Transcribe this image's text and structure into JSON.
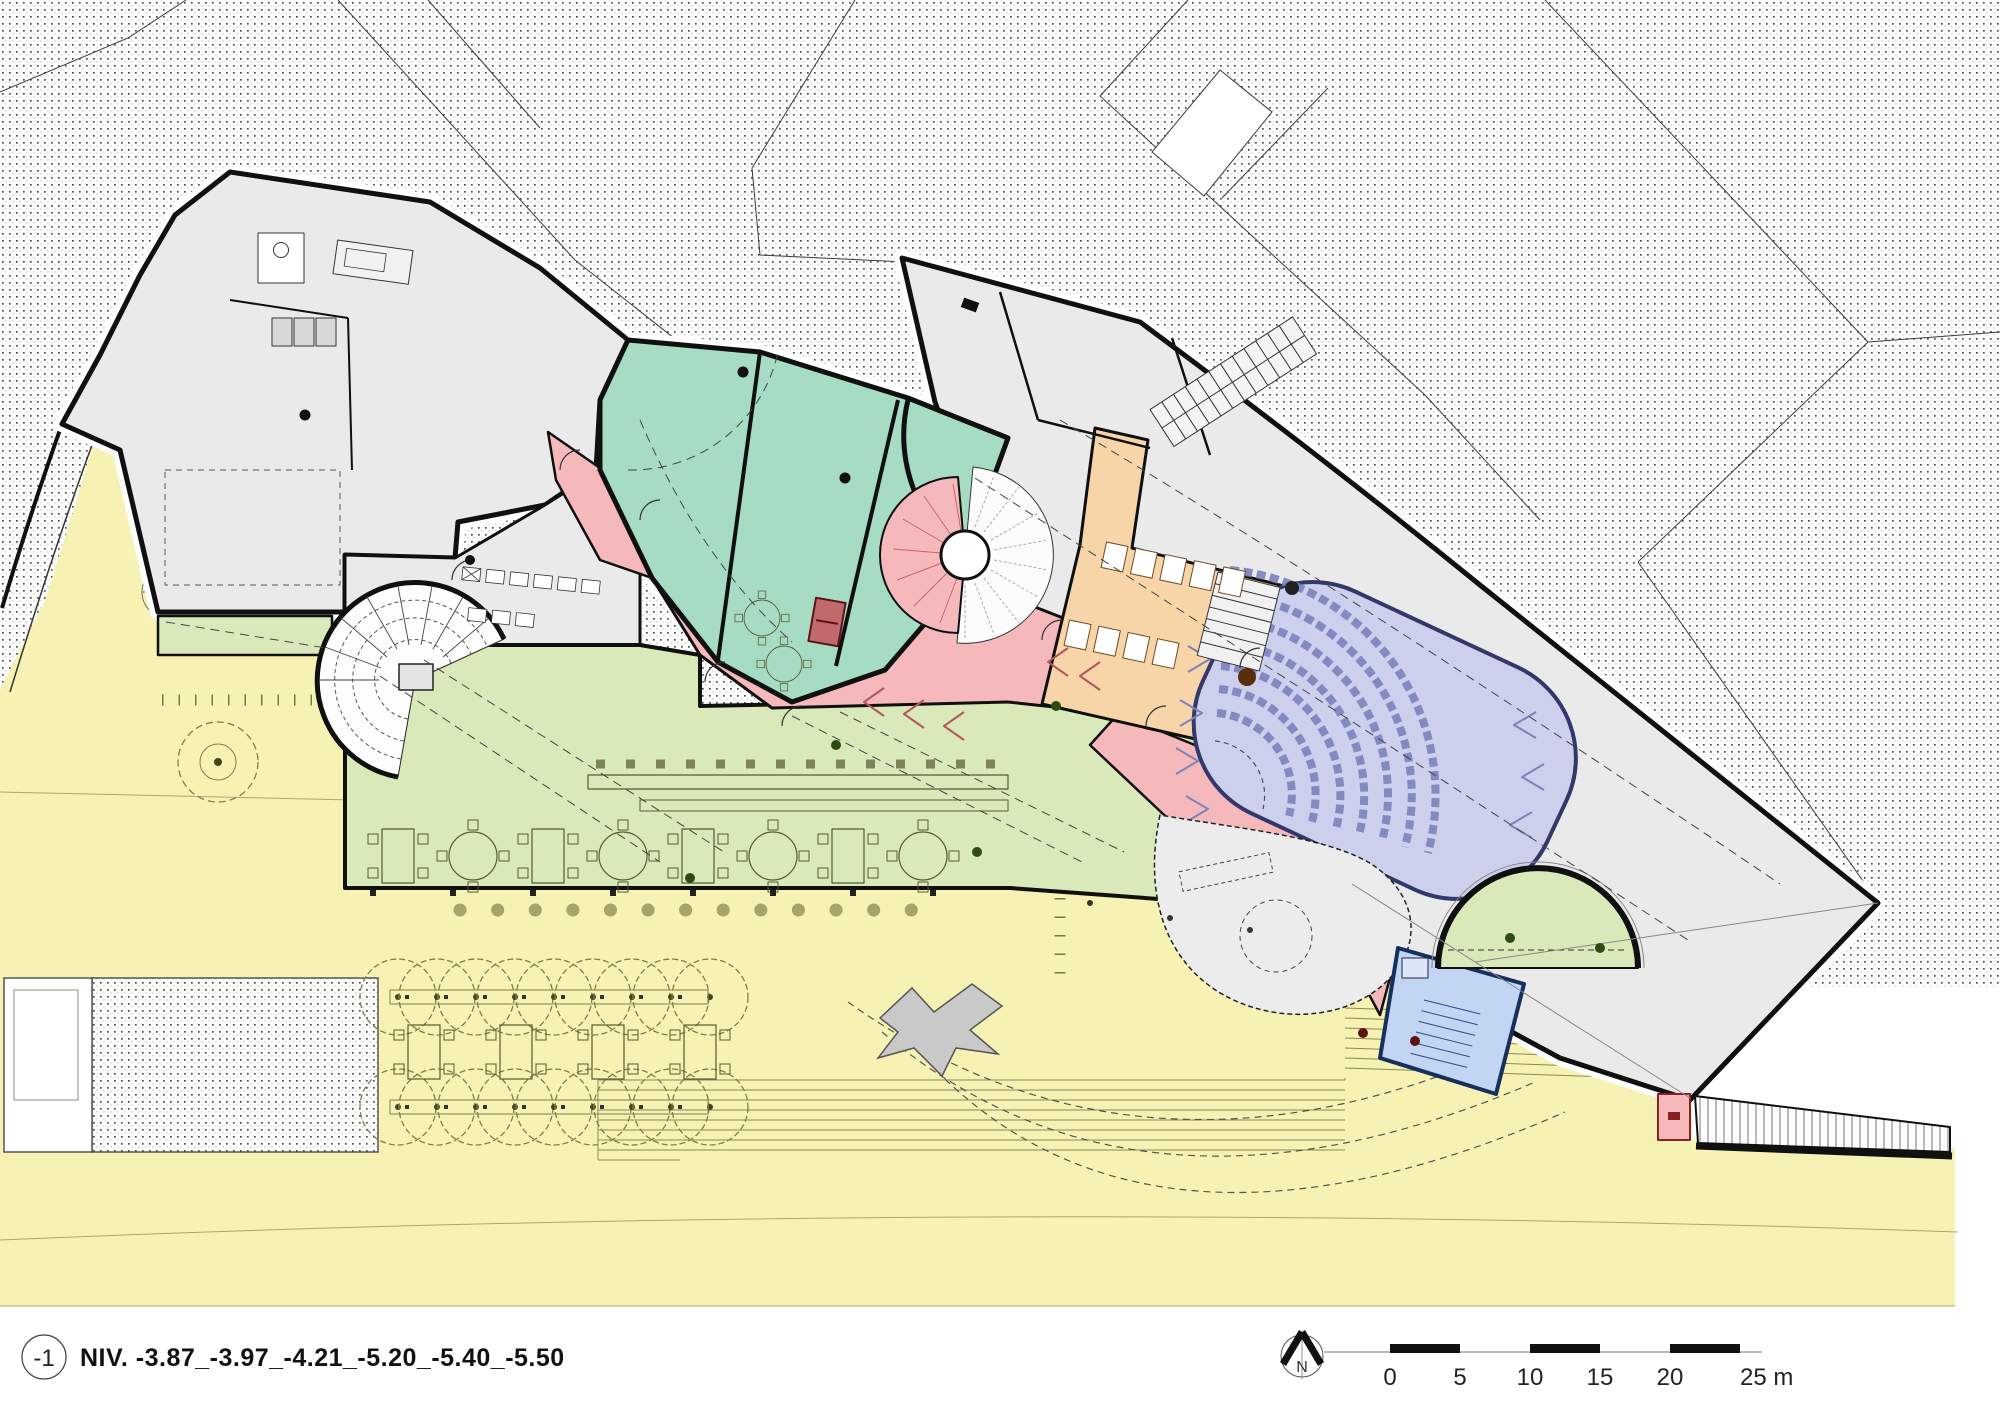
{
  "legend": {
    "level_badge": "-1",
    "title": "NIV. -3.87_-3.97_-4.21_-5.20_-5.40_-5.50"
  },
  "north_arrow": {
    "label": "N"
  },
  "scale_bar": {
    "t0": "0",
    "t1": "5",
    "t2": "10",
    "t3": "15",
    "t4": "20",
    "t5": "25 m"
  },
  "colors": {
    "plaza": "#f6f2b3",
    "rooms": "#eaeaea",
    "mint": "#a6dcc3",
    "green": "#d9e9ba",
    "pink": "#f5b9bc",
    "orange": "#f8d5a9",
    "lavender": "#cdd0ec",
    "blue": "#c2d5f2",
    "stage": "#ececec",
    "dark_red": "#c06a6e",
    "hatch_dot": "#4d4d4d"
  },
  "zones": [
    {
      "id": "exterior-plaza",
      "color_key": "plaza"
    },
    {
      "id": "interior-rooms",
      "color_key": "rooms"
    },
    {
      "id": "mint-rooms",
      "color_key": "mint"
    },
    {
      "id": "green-terrace",
      "color_key": "green"
    },
    {
      "id": "pink-circulation",
      "color_key": "pink"
    },
    {
      "id": "orange-sanitary",
      "color_key": "orange"
    },
    {
      "id": "auditorium",
      "color_key": "lavender"
    },
    {
      "id": "blue-stair-room",
      "color_key": "blue"
    }
  ]
}
